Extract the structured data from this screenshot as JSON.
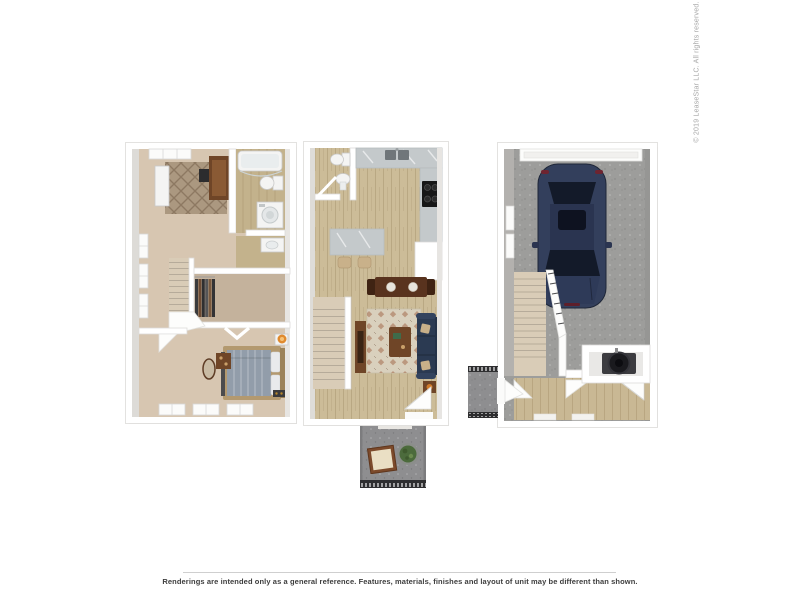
{
  "copyright": "© 2019 LeaseStar LLC. All rights reserved.",
  "footer": {
    "disclaimer": "Renderings are intended only as a general reference. Features, materials, finishes and layout of unit may be different than shown."
  },
  "floorplans": [
    {
      "id": "upper-level",
      "description": "bedroom with rug and desk, bathroom with tub and washer, walk-in closet, master bedroom with bed, stairs"
    },
    {
      "id": "main-level",
      "description": "half bath, kitchen with island and stools, dining table, living room with sofa rug and TV console, stairs, entry door"
    },
    {
      "id": "patio",
      "description": "concrete balcony with side table, plant and railing"
    },
    {
      "id": "garage-level",
      "description": "single-car garage with parked car, garage door, stairs up, utility closet with water heater, entry hall and stoop"
    }
  ],
  "palette": {
    "wall": "#ffffff",
    "wall_stroke": "#dcdbd9",
    "carpet": "#d7c6b1",
    "carpet_dark": "#c4b29c",
    "rug_taupe": "#ab9880",
    "rug_cream": "#d9d0bd",
    "wood": "#ccbc98",
    "wood_dark": "#c3b28c",
    "marble": "#c4c9cb",
    "stove_black": "#171717",
    "car_navy": "#333f5c",
    "glass_dark": "#131a29",
    "sofa_navy": "#2b3a52",
    "wood_brown": "#6f4527",
    "wood_brown_dark": "#59331e",
    "lamp_orange": "#e08a2e",
    "plant_green": "#4c6b3c",
    "concrete": "#9d9d9b",
    "concrete_dark": "#8e8e90",
    "railing_dark": "#2e2e30",
    "stairs_beige": "#d9ccb7",
    "fixture_white": "#f4f4f3",
    "bed_blanket": "#929daa",
    "bed_frame": "#b3996f",
    "pillow_white": "#e9eaec",
    "text_dark": "#3d3d3d",
    "text_light": "#a6a6a6",
    "rule_line": "#cfcfcf"
  }
}
